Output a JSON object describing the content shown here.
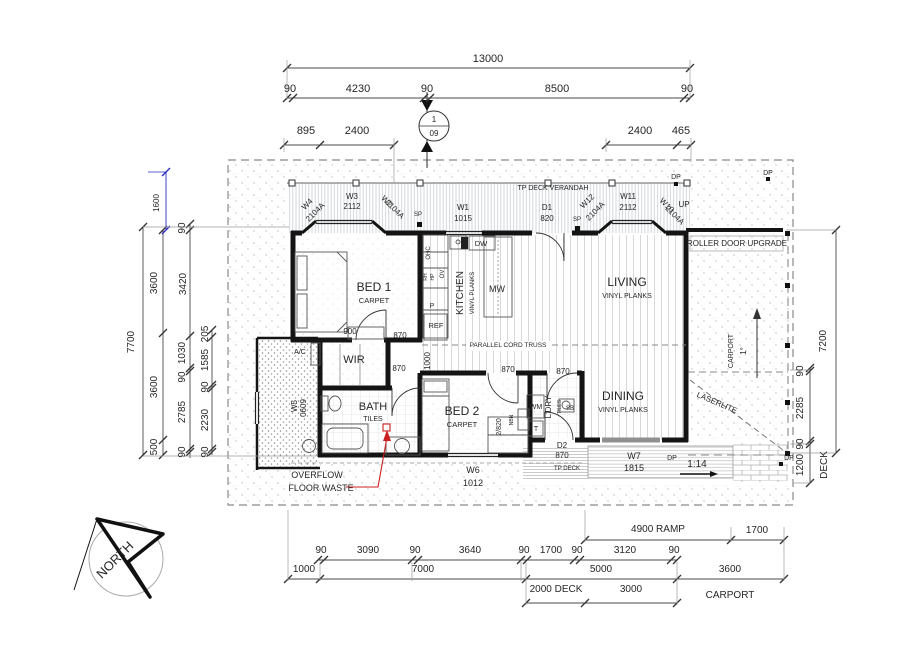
{
  "marker": {
    "top": "1",
    "bottom": "09"
  },
  "colors": {
    "ink": "#262626",
    "red": "#cc1f1f",
    "blue": "#2b2bc4",
    "dim": "#4a4a4a"
  },
  "annotations": {
    "top_dimensions": [
      {
        "n": "dim-overall-13000",
        "t": "13000",
        "x": 488,
        "y": 62,
        "s": 11
      },
      {
        "n": "dim-90-a",
        "t": "90",
        "x": 290,
        "y": 92,
        "s": 11
      },
      {
        "n": "dim-4230",
        "t": "4230",
        "x": 358,
        "y": 92,
        "s": 11
      },
      {
        "n": "dim-90-b",
        "t": "90",
        "x": 427,
        "y": 92,
        "s": 11
      },
      {
        "n": "dim-8500",
        "t": "8500",
        "x": 557,
        "y": 92,
        "s": 11
      },
      {
        "n": "dim-90-c",
        "t": "90",
        "x": 687,
        "y": 92,
        "s": 11
      },
      {
        "n": "dim-895",
        "t": "895",
        "x": 306,
        "y": 134,
        "s": 11
      },
      {
        "n": "dim-2400-left",
        "t": "2400",
        "x": 357,
        "y": 134,
        "s": 11
      },
      {
        "n": "dim-2400-right",
        "t": "2400",
        "x": 640,
        "y": 134,
        "s": 11
      },
      {
        "n": "dim-465",
        "t": "465",
        "x": 681,
        "y": 134,
        "s": 11
      }
    ],
    "verandah_labels": [
      {
        "n": "verandah-title",
        "t": "TP DECK VERANDAH",
        "x": 553,
        "y": 190,
        "s": 7
      },
      {
        "n": "window-w4",
        "t": "W4",
        "x": 309,
        "y": 206,
        "s": 8,
        "r": -45
      },
      {
        "n": "window-w4-size",
        "t": "2104A",
        "x": 317,
        "y": 214,
        "s": 8,
        "r": -45
      },
      {
        "n": "window-w3",
        "t": "W3",
        "x": 352,
        "y": 199,
        "s": 8
      },
      {
        "n": "window-w3-size",
        "t": "2112",
        "x": 352,
        "y": 209,
        "s": 8
      },
      {
        "n": "window-w2",
        "t": "W2",
        "x": 385,
        "y": 203,
        "s": 8,
        "r": 45
      },
      {
        "n": "window-w2-size",
        "t": "2104A",
        "x": 393,
        "y": 211,
        "s": 8,
        "r": 45
      },
      {
        "n": "post-sp-1",
        "t": "SP",
        "x": 418,
        "y": 216,
        "s": 6
      },
      {
        "n": "window-w1",
        "t": "W1",
        "x": 463,
        "y": 210,
        "s": 8
      },
      {
        "n": "window-w1-size",
        "t": "1015",
        "x": 463,
        "y": 221,
        "s": 8
      },
      {
        "n": "door-d1",
        "t": "D1",
        "x": 547,
        "y": 210,
        "s": 8
      },
      {
        "n": "door-d1-size",
        "t": "820",
        "x": 547,
        "y": 221,
        "s": 8
      },
      {
        "n": "post-sp-2",
        "t": "SP",
        "x": 577,
        "y": 221,
        "s": 6
      },
      {
        "n": "window-w12",
        "t": "W12",
        "x": 589,
        "y": 203,
        "s": 8,
        "r": -45
      },
      {
        "n": "window-w12-size",
        "t": "2104A",
        "x": 597,
        "y": 213,
        "s": 8,
        "r": -45
      },
      {
        "n": "window-w11",
        "t": "W11",
        "x": 628,
        "y": 199,
        "s": 8
      },
      {
        "n": "window-w11-size",
        "t": "2112",
        "x": 628,
        "y": 210,
        "s": 8
      },
      {
        "n": "window-w10",
        "t": "W10",
        "x": 665,
        "y": 207,
        "s": 8,
        "r": 45
      },
      {
        "n": "window-w10-size",
        "t": "2104A",
        "x": 673,
        "y": 217,
        "s": 8,
        "r": 45
      },
      {
        "n": "downpipe-top",
        "t": "DP",
        "x": 676,
        "y": 179,
        "s": 7
      },
      {
        "n": "downpipe-topright",
        "t": "DP",
        "x": 768,
        "y": 175,
        "s": 7
      },
      {
        "n": "note-up",
        "t": "UP",
        "x": 684,
        "y": 207,
        "s": 8
      }
    ],
    "rooms": [
      {
        "n": "room-bed1",
        "t": "BED 1",
        "x": 374,
        "y": 291,
        "s": 12
      },
      {
        "n": "room-bed1-finish",
        "t": "CARPET",
        "x": 374,
        "y": 303,
        "s": 7.5
      },
      {
        "n": "room-wir",
        "t": "WIR",
        "x": 354,
        "y": 363,
        "s": 11
      },
      {
        "n": "room-bath",
        "t": "BATH",
        "x": 373,
        "y": 410,
        "s": 11
      },
      {
        "n": "room-bath-finish",
        "t": "TILES",
        "x": 373,
        "y": 421,
        "s": 7
      },
      {
        "n": "room-bed2",
        "t": "BED 2",
        "x": 462,
        "y": 415,
        "s": 12
      },
      {
        "n": "room-bed2-finish",
        "t": "CARPET",
        "x": 462,
        "y": 427,
        "s": 7.5
      },
      {
        "n": "room-kitchen",
        "t": "KITCHEN",
        "x": 463,
        "y": 293,
        "s": 10,
        "r": -90
      },
      {
        "n": "room-kitchen-finish",
        "t": "VINYL PLANKS",
        "x": 474,
        "y": 293,
        "s": 6,
        "r": -90
      },
      {
        "n": "room-living",
        "t": "LIVING",
        "x": 627,
        "y": 286,
        "s": 12
      },
      {
        "n": "room-living-finish",
        "t": "VINYL PLANKS",
        "x": 627,
        "y": 298,
        "s": 7
      },
      {
        "n": "room-dining",
        "t": "DINING",
        "x": 623,
        "y": 400,
        "s": 12
      },
      {
        "n": "room-dining-finish",
        "t": "VINYL PLANKS",
        "x": 623,
        "y": 412,
        "s": 7
      },
      {
        "n": "room-ldry",
        "t": "L'DRY",
        "x": 551,
        "y": 407,
        "s": 8,
        "r": -90
      },
      {
        "n": "room-ldry-finish",
        "t": "TILES",
        "x": 561,
        "y": 407,
        "s": 5,
        "r": -90
      },
      {
        "n": "note-truss",
        "t": "PARALLEL CORD TRUSS",
        "x": 508,
        "y": 347,
        "s": 6.5
      }
    ],
    "fixtures": [
      {
        "n": "fixture-ohc",
        "t": "OHC",
        "x": 430,
        "y": 253,
        "s": 6,
        "r": -90
      },
      {
        "n": "fixture-rh",
        "t": "RH",
        "x": 427,
        "y": 277,
        "s": 5,
        "r": -90
      },
      {
        "n": "fixture-hp",
        "t": "HP",
        "x": 434,
        "y": 277,
        "s": 5,
        "r": -90
      },
      {
        "n": "fixture-ov",
        "t": "OV",
        "x": 444,
        "y": 274,
        "s": 6,
        "r": -90
      },
      {
        "n": "fixture-pantry",
        "t": "P",
        "x": 432,
        "y": 308,
        "s": 7
      },
      {
        "n": "fixture-ref",
        "t": "REF",
        "x": 436,
        "y": 328,
        "s": 7.5
      },
      {
        "n": "fixture-dw",
        "t": "DW",
        "x": 481,
        "y": 246,
        "s": 7.5
      },
      {
        "n": "fixture-mw",
        "t": "MW",
        "x": 497,
        "y": 292,
        "s": 9
      },
      {
        "n": "fixture-wm",
        "t": "WM",
        "x": 536,
        "y": 409,
        "s": 7
      },
      {
        "n": "fixture-dryer",
        "t": "T",
        "x": 536,
        "y": 431,
        "s": 7
      },
      {
        "n": "fixture-sb",
        "t": "SB",
        "x": 570,
        "y": 410,
        "s": 6
      },
      {
        "n": "fixture-nbn",
        "t": "NBN",
        "x": 513,
        "y": 420,
        "s": 5,
        "r": -90
      },
      {
        "n": "robe-2-820",
        "t": "2/820",
        "x": 501,
        "y": 427,
        "s": 7,
        "r": -90
      },
      {
        "n": "fixture-ac",
        "t": "A/C",
        "x": 300,
        "y": 354,
        "s": 7
      },
      {
        "n": "window-w5",
        "t": "W5",
        "x": 297,
        "y": 406,
        "s": 8,
        "r": -90
      },
      {
        "n": "window-w5-size",
        "t": "0609",
        "x": 306,
        "y": 408,
        "s": 8,
        "r": -90
      },
      {
        "n": "window-w6",
        "t": "W6",
        "x": 473,
        "y": 473,
        "s": 9
      },
      {
        "n": "window-w6-size",
        "t": "1012",
        "x": 473,
        "y": 486,
        "s": 9
      },
      {
        "n": "door-d2",
        "t": "D2",
        "x": 562,
        "y": 448,
        "s": 8
      },
      {
        "n": "door-d2-size",
        "t": "870",
        "x": 562,
        "y": 458,
        "s": 8
      },
      {
        "n": "deck-tp",
        "t": "TP DECK",
        "x": 567,
        "y": 470,
        "s": 6
      },
      {
        "n": "window-w7",
        "t": "W7",
        "x": 634,
        "y": 459,
        "s": 9
      },
      {
        "n": "window-w7-size",
        "t": "1815",
        "x": 634,
        "y": 471,
        "s": 9
      },
      {
        "n": "downpipe-deck",
        "t": "DP",
        "x": 672,
        "y": 460,
        "s": 7
      },
      {
        "n": "ramp-grade",
        "t": "1:14",
        "x": 697,
        "y": 467,
        "s": 10
      },
      {
        "n": "downpipe-se",
        "t": "DP",
        "x": 789,
        "y": 460,
        "s": 7
      },
      {
        "n": "carport-vertical",
        "t": "CARPORT",
        "x": 733,
        "y": 351,
        "s": 7,
        "r": -90
      },
      {
        "n": "carport-fall",
        "t": "1°",
        "x": 746,
        "y": 351,
        "s": 8,
        "r": -90
      },
      {
        "n": "note-laserlite",
        "t": "LASERLITE",
        "x": 716,
        "y": 405,
        "s": 8,
        "r": 23
      }
    ],
    "interior_dims": [
      {
        "n": "dim-robe-900",
        "t": "900",
        "x": 350,
        "y": 334,
        "s": 8
      },
      {
        "n": "dim-door-870-bed1",
        "t": "870",
        "x": 400,
        "y": 338,
        "s": 8
      },
      {
        "n": "dim-hall-1000",
        "t": "1000",
        "x": 430,
        "y": 361,
        "s": 8,
        "r": -90
      },
      {
        "n": "dim-door-870-hall",
        "t": "870",
        "x": 399,
        "y": 371,
        "s": 8
      },
      {
        "n": "dim-door-870-bed2",
        "t": "870",
        "x": 508,
        "y": 372,
        "s": 8
      },
      {
        "n": "dim-door-870-ldry",
        "t": "870",
        "x": 563,
        "y": 374,
        "s": 8
      }
    ],
    "left_dimensions": [
      {
        "n": "dim-left-7700",
        "t": "7700",
        "x": 134,
        "y": 342,
        "s": 10,
        "r": -90
      },
      {
        "n": "dim-left-1600",
        "t": "1600",
        "x": 159,
        "y": 203,
        "s": 8,
        "r": -90,
        "c": "blue"
      },
      {
        "n": "dim-left-3600-a",
        "t": "3600",
        "x": 157,
        "y": 283,
        "s": 10,
        "r": -90
      },
      {
        "n": "dim-left-3600-b",
        "t": "3600",
        "x": 157,
        "y": 387,
        "s": 10,
        "r": -90
      },
      {
        "n": "dim-left-500",
        "t": "500",
        "x": 157,
        "y": 447,
        "s": 10,
        "r": -90
      },
      {
        "n": "dim-left-90-a",
        "t": "90",
        "x": 185,
        "y": 228,
        "s": 10,
        "r": -90
      },
      {
        "n": "dim-left-3420",
        "t": "3420",
        "x": 186,
        "y": 284,
        "s": 10,
        "r": -90
      },
      {
        "n": "dim-left-1030",
        "t": "1030",
        "x": 185,
        "y": 353,
        "s": 10,
        "r": -90
      },
      {
        "n": "dim-left-90-b",
        "t": "90",
        "x": 185,
        "y": 377,
        "s": 10,
        "r": -90
      },
      {
        "n": "dim-left-2785",
        "t": "2785",
        "x": 185,
        "y": 412,
        "s": 10,
        "r": -90
      },
      {
        "n": "dim-left-90-c",
        "t": "90",
        "x": 185,
        "y": 452,
        "s": 10,
        "r": -90
      },
      {
        "n": "dim-left-205",
        "t": "205",
        "x": 208,
        "y": 334,
        "s": 10,
        "r": -90
      },
      {
        "n": "dim-left-1585",
        "t": "1585",
        "x": 208,
        "y": 360,
        "s": 10,
        "r": -90
      },
      {
        "n": "dim-left-90-d",
        "t": "90",
        "x": 208,
        "y": 387,
        "s": 10,
        "r": -90
      },
      {
        "n": "dim-left-2230",
        "t": "2230",
        "x": 208,
        "y": 420,
        "s": 10,
        "r": -90
      },
      {
        "n": "dim-left-90-e",
        "t": "90",
        "x": 208,
        "y": 452,
        "s": 10,
        "r": -90
      }
    ],
    "right_dimensions": [
      {
        "n": "dim-right-7200",
        "t": "7200",
        "x": 826,
        "y": 341,
        "s": 10,
        "r": -90
      },
      {
        "n": "dim-right-90-a",
        "t": "90",
        "x": 803,
        "y": 371,
        "s": 10,
        "r": -90
      },
      {
        "n": "dim-right-2285",
        "t": "2285",
        "x": 803,
        "y": 408,
        "s": 10,
        "r": -90
      },
      {
        "n": "dim-right-90-b",
        "t": "90",
        "x": 803,
        "y": 444,
        "s": 10,
        "r": -90
      },
      {
        "n": "dim-right-1200",
        "t": "1200",
        "x": 803,
        "y": 465,
        "s": 10,
        "r": -90
      },
      {
        "n": "label-deck",
        "t": "DECK",
        "x": 827,
        "y": 465,
        "s": 10,
        "r": -90
      }
    ],
    "bottom_dimensions": [
      {
        "n": "dim-ramp-4900",
        "t": "4900 RAMP",
        "x": 658,
        "y": 532,
        "s": 10
      },
      {
        "n": "dim-ramp-1700",
        "t": "1700",
        "x": 757,
        "y": 533,
        "s": 10
      },
      {
        "n": "dim-bot-90-a",
        "t": "90",
        "x": 321,
        "y": 553,
        "s": 10
      },
      {
        "n": "dim-bot-3090",
        "t": "3090",
        "x": 368,
        "y": 553,
        "s": 10
      },
      {
        "n": "dim-bot-90-b",
        "t": "90",
        "x": 415,
        "y": 553,
        "s": 10
      },
      {
        "n": "dim-bot-3640",
        "t": "3640",
        "x": 470,
        "y": 553,
        "s": 10
      },
      {
        "n": "dim-bot-90-c",
        "t": "90",
        "x": 524,
        "y": 553,
        "s": 10
      },
      {
        "n": "dim-bot-1700",
        "t": "1700",
        "x": 551,
        "y": 553,
        "s": 10
      },
      {
        "n": "dim-bot-90-d",
        "t": "90",
        "x": 577,
        "y": 553,
        "s": 10
      },
      {
        "n": "dim-bot-3120",
        "t": "3120",
        "x": 625,
        "y": 553,
        "s": 10
      },
      {
        "n": "dim-bot-90-e",
        "t": "90",
        "x": 674,
        "y": 553,
        "s": 10
      },
      {
        "n": "dim-bot-1000",
        "t": "1000",
        "x": 304,
        "y": 572,
        "s": 10
      },
      {
        "n": "dim-bot-7000",
        "t": "7000",
        "x": 423,
        "y": 572,
        "s": 10
      },
      {
        "n": "dim-bot-5000",
        "t": "5000",
        "x": 601,
        "y": 572,
        "s": 10
      },
      {
        "n": "dim-bot-3600",
        "t": "3600",
        "x": 730,
        "y": 572,
        "s": 10
      },
      {
        "n": "dim-bot-2000-deck",
        "t": "2000 DECK",
        "x": 556,
        "y": 592,
        "s": 10
      },
      {
        "n": "dim-bot-3000",
        "t": "3000",
        "x": 631,
        "y": 592,
        "s": 10
      },
      {
        "n": "label-carport-bottom",
        "t": "CARPORT",
        "x": 730,
        "y": 598,
        "s": 10
      }
    ],
    "red_notes": [
      {
        "n": "note-roller-door",
        "t": "ROLLER DOOR UPGRADE",
        "x": 737,
        "y": 246,
        "s": 8,
        "c": "red"
      },
      {
        "n": "note-overflow-1",
        "t": "OVERFLOW",
        "x": 317,
        "y": 478,
        "s": 9,
        "c": "red"
      },
      {
        "n": "note-overflow-2",
        "t": "FLOOR WASTE",
        "x": 321,
        "y": 491,
        "s": 9,
        "c": "red"
      }
    ],
    "compass": [
      {
        "n": "north-label",
        "t": "NORTH",
        "x": 118,
        "y": 563,
        "s": 13,
        "r": -45
      }
    ]
  }
}
